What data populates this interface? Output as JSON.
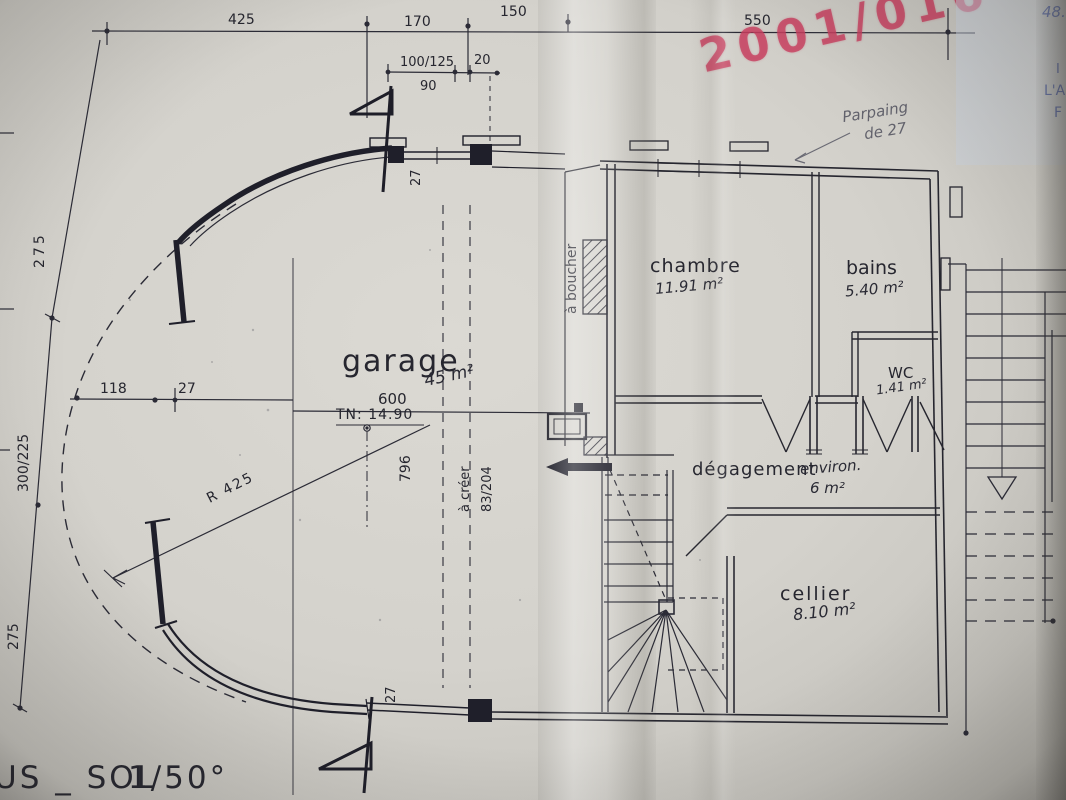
{
  "meta": {
    "stamp": "2001/016"
  },
  "notes": {
    "corner_1": "48.",
    "corner_2": "I",
    "corner_3": "L'A",
    "corner_4": "F",
    "pencil_1": "Parpaing",
    "pencil_2": "de 27",
    "a_boucher": "à boucher",
    "a_creer": "à créer",
    "tn": "TN: 14.90",
    "radius": "R 425"
  },
  "dims": {
    "t425": "425",
    "t170": "170",
    "t150": "150",
    "t550": "550",
    "t100_125": "100/125",
    "t20": "20",
    "t90": "90",
    "l275a": "275",
    "l300_225": "300/225",
    "l275b": "275",
    "g118": "118",
    "g27a": "27",
    "g27b": "27",
    "g27c": "27",
    "g600": "600",
    "g796": "796",
    "g83_204": "83/204"
  },
  "rooms": {
    "garage": {
      "name": "garage",
      "area": "45 m²"
    },
    "chambre": {
      "name": "chambre",
      "area": "11.91 m²"
    },
    "bains": {
      "name": "bains",
      "area": "5.40 m²"
    },
    "wc": {
      "name": "WC",
      "area": "1.41 m²"
    },
    "degagement": {
      "name": "dégagement",
      "qualifier": "environ.",
      "area": "6 m²"
    },
    "cellier": {
      "name": "cellier",
      "area": "8.10 m²"
    }
  },
  "footer": {
    "title": "US _ SOL",
    "scale": "1/50°"
  }
}
